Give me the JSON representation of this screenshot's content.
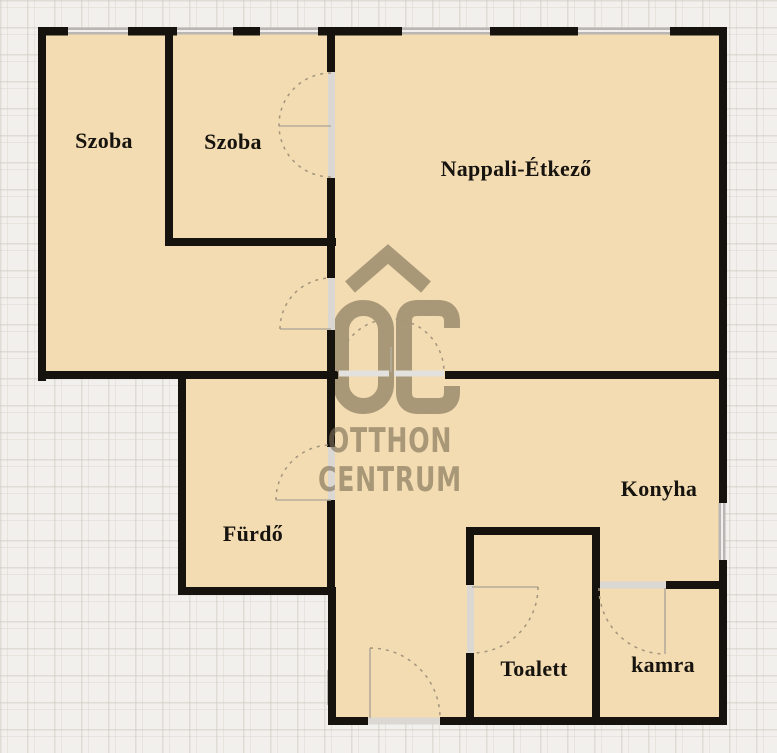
{
  "plan": {
    "type": "apartment floor plan",
    "rooms": [
      {
        "id": "szoba-1",
        "label": "Szoba"
      },
      {
        "id": "szoba-2",
        "label": "Szoba"
      },
      {
        "id": "nappali-etkezo",
        "label": "Nappali-Étkező"
      },
      {
        "id": "furdo",
        "label": "Fürdő"
      },
      {
        "id": "konyha",
        "label": "Konyha"
      },
      {
        "id": "toalett",
        "label": "Toalett"
      },
      {
        "id": "kamra",
        "label": "kamra"
      }
    ]
  },
  "watermark": {
    "logo": "OC",
    "line1": "OTTHON",
    "line2": "CENTRUM"
  },
  "colors": {
    "room_fill": "#f3dcb2",
    "wall": "#16130f",
    "background": "#f2f0ec",
    "window_gray": "#b9b6b3",
    "door_arc": "#a3947c",
    "watermark": "#7d6f56"
  }
}
